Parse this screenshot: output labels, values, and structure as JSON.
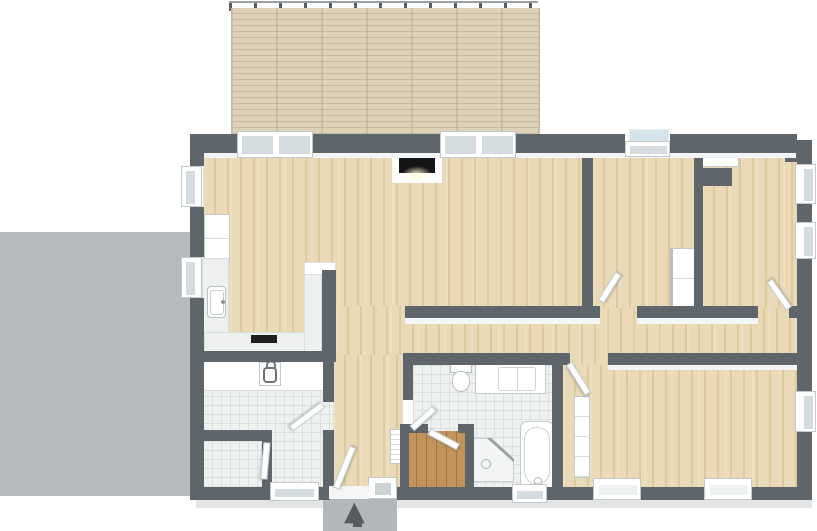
{
  "meta": {
    "title": "house floor plan",
    "style": "3d-top-down-render",
    "canvas_width": 817,
    "canvas_height": 531
  },
  "icons": {
    "entrance_arrow": "▲"
  },
  "colors": {
    "wall": "#5f666b",
    "wall_face": "#f3f4f5",
    "wood": "#e9d9b6",
    "deck": "#ddd2b9",
    "tile": "#eef1f0",
    "tile_grid": "#d9e0df",
    "sauna_wood": "#c2945c",
    "patio": "#b7babc",
    "stoop": "#b4b7b9",
    "apron": "#e2e4e5",
    "glass": "#d5dcdf",
    "sill_glass": "#d3e5ea",
    "counter": "#eef0f0",
    "fixture_border": "#c3c9cb",
    "cooktop": "#1e1f20",
    "firebox": "#151515",
    "arrow": "#565c60"
  },
  "rooms": [
    {
      "name": "deck",
      "floor": "wood-planks"
    },
    {
      "name": "patio",
      "floor": "concrete"
    },
    {
      "name": "living-room-with-kitchen",
      "floor": "light-oak"
    },
    {
      "name": "hallway",
      "floor": "light-oak"
    },
    {
      "name": "entry-hall",
      "floor": "light-oak"
    },
    {
      "name": "bedroom-center",
      "floor": "light-oak"
    },
    {
      "name": "bedroom-northeast",
      "floor": "light-oak"
    },
    {
      "name": "master-bedroom",
      "floor": "light-oak"
    },
    {
      "name": "bathroom",
      "floor": "white-tile"
    },
    {
      "name": "sauna",
      "floor": "warm-wood"
    },
    {
      "name": "laundry-room",
      "floor": "white-tile"
    },
    {
      "name": "wc",
      "floor": "white-tile"
    }
  ],
  "fixtures": [
    "kitchen-tall-cabinets",
    "kitchen-sink",
    "kitchen-counter",
    "cooktop",
    "laundry-counter",
    "laundry-sink",
    "wall-hooks",
    "fireplace",
    "toilet",
    "double-vanity",
    "bathtub",
    "corner-shower",
    "entry-bench",
    "wardrobe-bedroom-center",
    "wardrobe-master-bedroom",
    "cabinet-bedroom-northeast",
    "entrance-arrow"
  ],
  "windows_count": 13,
  "doors_count": 8
}
